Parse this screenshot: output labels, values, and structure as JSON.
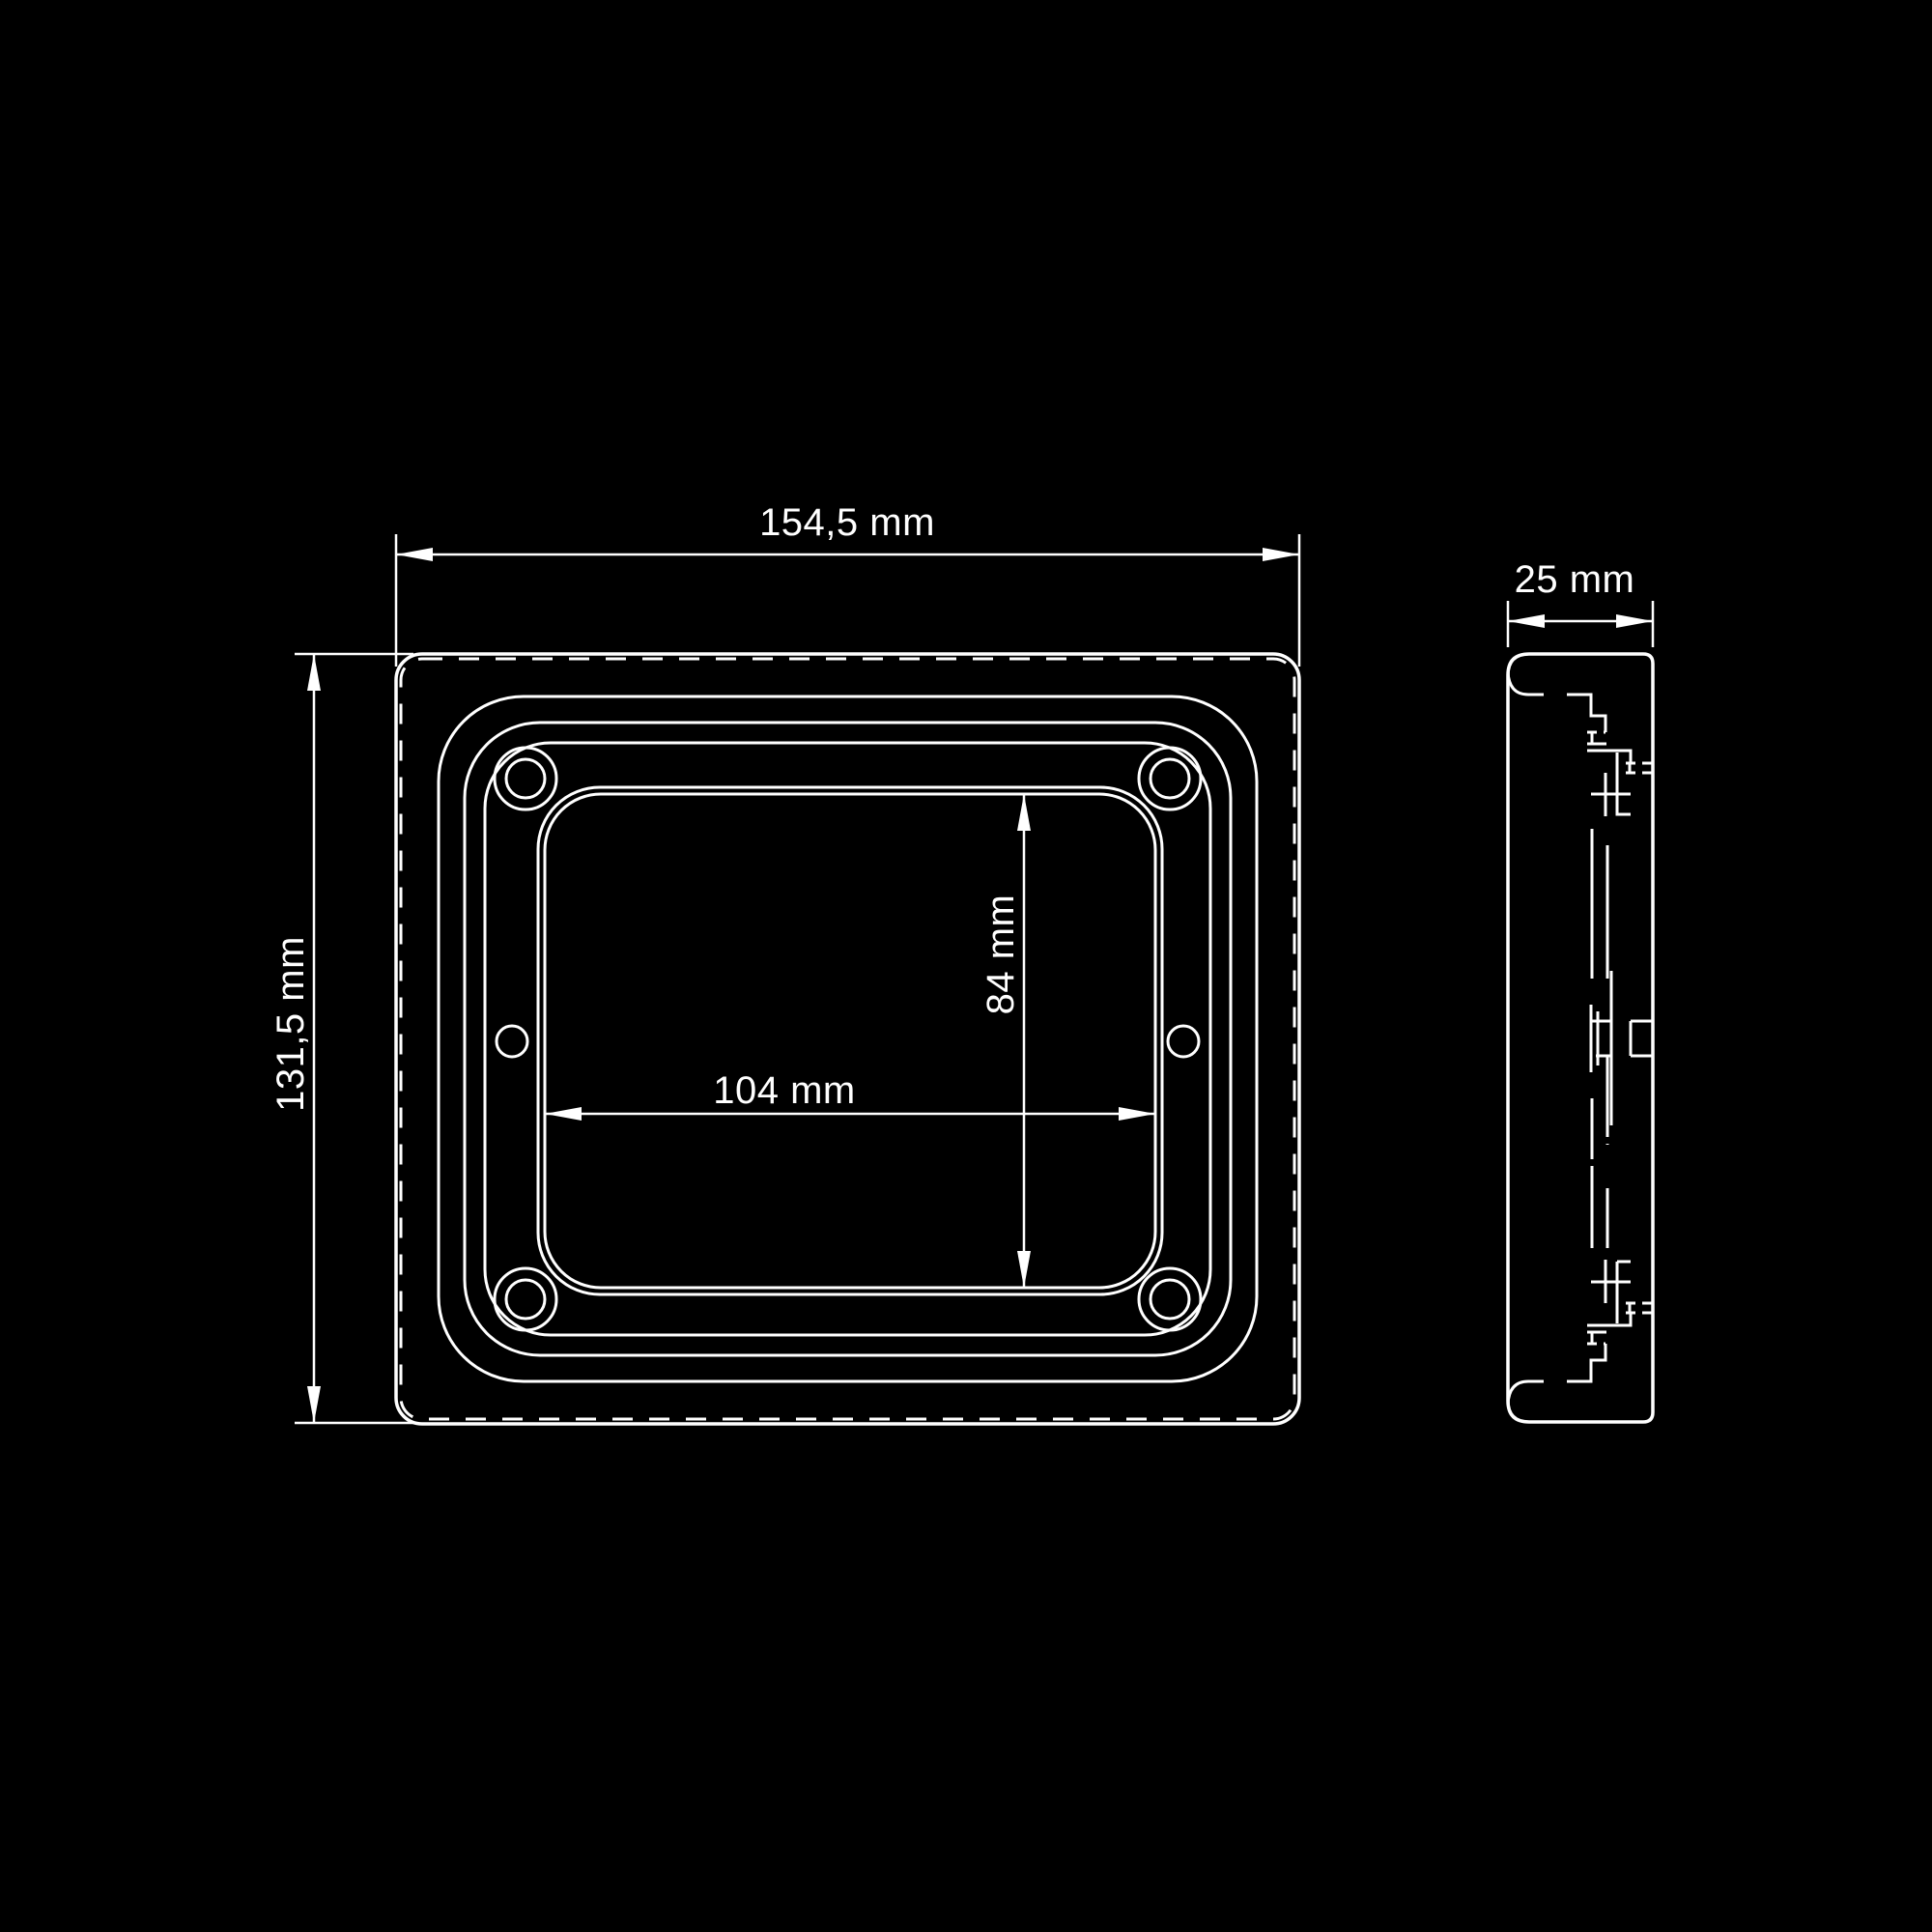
{
  "drawing": {
    "type": "technical-dimension-drawing",
    "background_color": "#000000",
    "line_color": "#ffffff",
    "views": [
      {
        "id": "front-view",
        "description": "front elevation of rounded rectangular frame with four corner screw bosses, two mid-edge holes and central rectangular opening"
      },
      {
        "id": "side-view",
        "description": "side profile, 25 mm deep, with snap-clip features"
      }
    ],
    "dimensions": {
      "overall_width": {
        "label": "154,5 mm",
        "value_mm": 154.5,
        "orientation": "horizontal",
        "applies_to": "front-view overall width"
      },
      "overall_height": {
        "label": "131,5 mm",
        "value_mm": 131.5,
        "orientation": "vertical",
        "applies_to": "front-view overall height"
      },
      "opening_width": {
        "label": "104 mm",
        "value_mm": 104,
        "orientation": "horizontal",
        "applies_to": "inner opening width"
      },
      "opening_height": {
        "label": "84 mm",
        "value_mm": 84,
        "orientation": "vertical",
        "applies_to": "inner opening height"
      },
      "depth": {
        "label": "25 mm",
        "value_mm": 25,
        "orientation": "horizontal",
        "applies_to": "side-view depth"
      }
    }
  }
}
